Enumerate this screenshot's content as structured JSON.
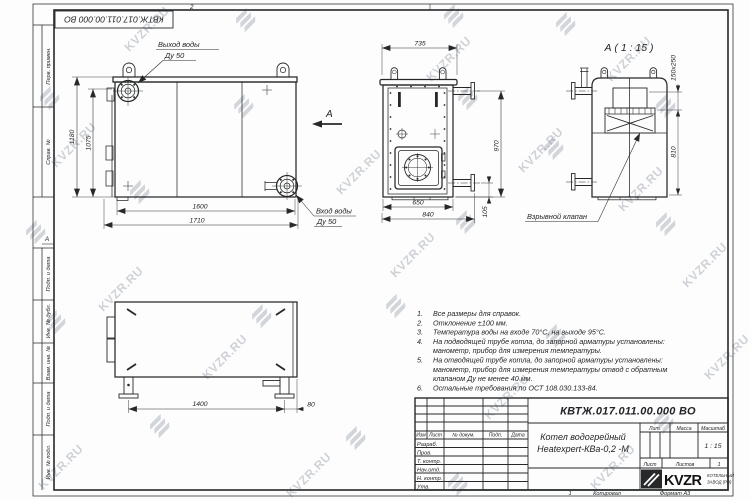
{
  "watermark": {
    "text": "KVZR.RU",
    "text_items": [
      [
        118,
        22
      ],
      [
        420,
        52
      ],
      [
        600,
        52
      ],
      [
        45,
        138
      ],
      [
        330,
        165
      ],
      [
        612,
        182
      ],
      [
        92,
        282
      ],
      [
        384,
        248
      ],
      [
        676,
        258
      ],
      [
        196,
        350
      ],
      [
        478,
        390
      ],
      [
        32,
        460
      ],
      [
        280,
        468
      ],
      [
        584,
        460
      ],
      [
        698,
        350
      ],
      [
        512,
        143
      ]
    ],
    "glyph_items": [
      [
        238,
        12
      ],
      [
        446,
        8
      ],
      [
        558,
        16
      ],
      [
        42,
        90
      ],
      [
        236,
        98
      ],
      [
        460,
        90
      ],
      [
        658,
        98
      ],
      [
        132,
        184
      ],
      [
        28,
        224
      ],
      [
        546,
        140
      ],
      [
        458,
        214
      ],
      [
        658,
        216
      ],
      [
        48,
        314
      ],
      [
        254,
        308
      ],
      [
        388,
        298
      ],
      [
        548,
        328
      ],
      [
        152,
        418
      ],
      [
        348,
        430
      ],
      [
        656,
        414
      ],
      [
        450,
        476
      ]
    ]
  },
  "frame": {
    "stamp_doc_number": "КВТЖ.017.011.00.000 ВО",
    "zone_top": "2",
    "zone_left": "А",
    "labels": {
      "perv": "Перв. примен.",
      "sprav": "Справ. №",
      "podp1": "Подп. и дата",
      "inv_dubl": "Инв. № дубл.",
      "vzam": "Взам. инв. №",
      "podp2": "Подп. и дата",
      "inv_podl": "Инв. № подл."
    }
  },
  "front_view": {
    "outlet_label": "Выход воды",
    "outlet_dn": "Ду 50",
    "inlet_label": "Вход воды",
    "inlet_dn": "Ду 50",
    "dim_height_outer": "1180",
    "dim_height_inner": "1075",
    "dim_width_inner": "1600",
    "dim_width_outer": "1710",
    "view_arrow_label": "А"
  },
  "side_view": {
    "dim_top": "735",
    "dim_right": "970",
    "dim_bottom_inner": "650",
    "dim_bottom_outer": "840",
    "dim_offset": "105"
  },
  "detail_view": {
    "title": "А ( 1 : 15 )",
    "dim_valve": "150x250",
    "dim_height": "810",
    "valve_label": "Взрывной клапан"
  },
  "top_view": {
    "dim_length": "1400",
    "dim_offset": "80"
  },
  "notes": {
    "lines": [
      {
        "num": "1.",
        "text": "Все размеры для справок."
      },
      {
        "num": "2.",
        "text": "Отклонение ±100 мм."
      },
      {
        "num": "3.",
        "text": "Температура воды на входе 70°С, на выходе 95°С."
      },
      {
        "num": "4.",
        "text": "На подводящей трубе котла, до запорной арматуры установлены:"
      },
      {
        "num": "",
        "text": "манометр, прибор для измерения температуры."
      },
      {
        "num": "5.",
        "text": "На отводящей трубе котла, до запорной арматуры установлены:"
      },
      {
        "num": "",
        "text": "манометр, прибор для измерения температуры  отвод с обратным"
      },
      {
        "num": "",
        "text": "клапаном Ду не менее 40 мм."
      },
      {
        "num": "6.",
        "text": "Остальные требования по ОСТ 108.030.133-84."
      }
    ]
  },
  "title_block": {
    "doc_number": "КВТЖ.017.011.00.000 ВО",
    "product_name_1": "Котел водогрейный",
    "product_name_2": "Heatexpert-КВа-0,2 -М",
    "col_izm": "Изм",
    "col_list": "Лист",
    "col_doc": "№ докум.",
    "col_podp": "Подп.",
    "col_data": "Дата",
    "row_labels": [
      "Разраб.",
      "Пров.",
      "Т. контр.",
      "Нач.отд.",
      "Н. контр.",
      "Утв."
    ],
    "lit_label": "Лит.",
    "mass_label": "Масса",
    "scale_label": "Масштаб",
    "scale_value": "1 : 15",
    "sheet_label": "Лист",
    "sheets_label": "Листов",
    "sheets_value": "1",
    "logo_text": "KVZR",
    "logo_sub1": "КОТЕЛЬНЫЙ",
    "logo_sub2": "ЗАВОД (РЭ)",
    "copy_number": "1",
    "copied_label": "Копировал",
    "format_label": "Формат А3"
  }
}
